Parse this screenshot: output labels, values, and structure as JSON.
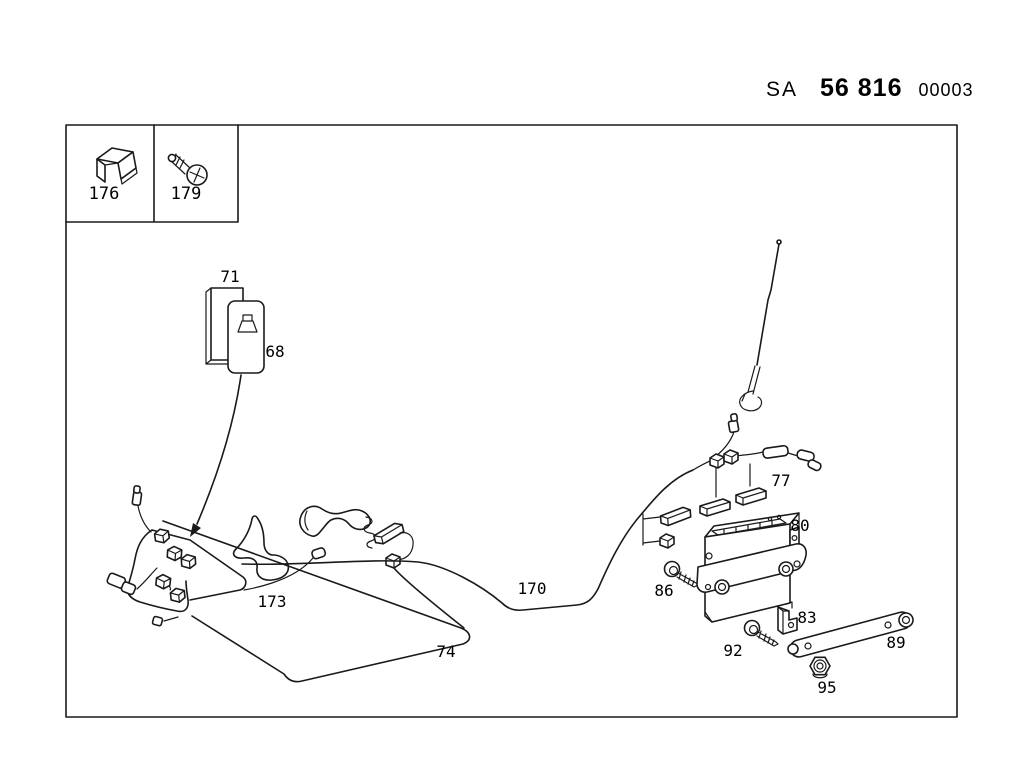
{
  "header": {
    "sa": "SA",
    "main_code": "56 816",
    "suffix": "00003"
  },
  "labels": {
    "p176": "176",
    "p179": "179",
    "p71": "71",
    "p68": "68",
    "p77": "77",
    "p80": "80",
    "p86": "86",
    "p83": "83",
    "p92": "92",
    "p89": "89",
    "p95": "95",
    "p170": "170",
    "p74": "74",
    "p173": "173"
  }
}
